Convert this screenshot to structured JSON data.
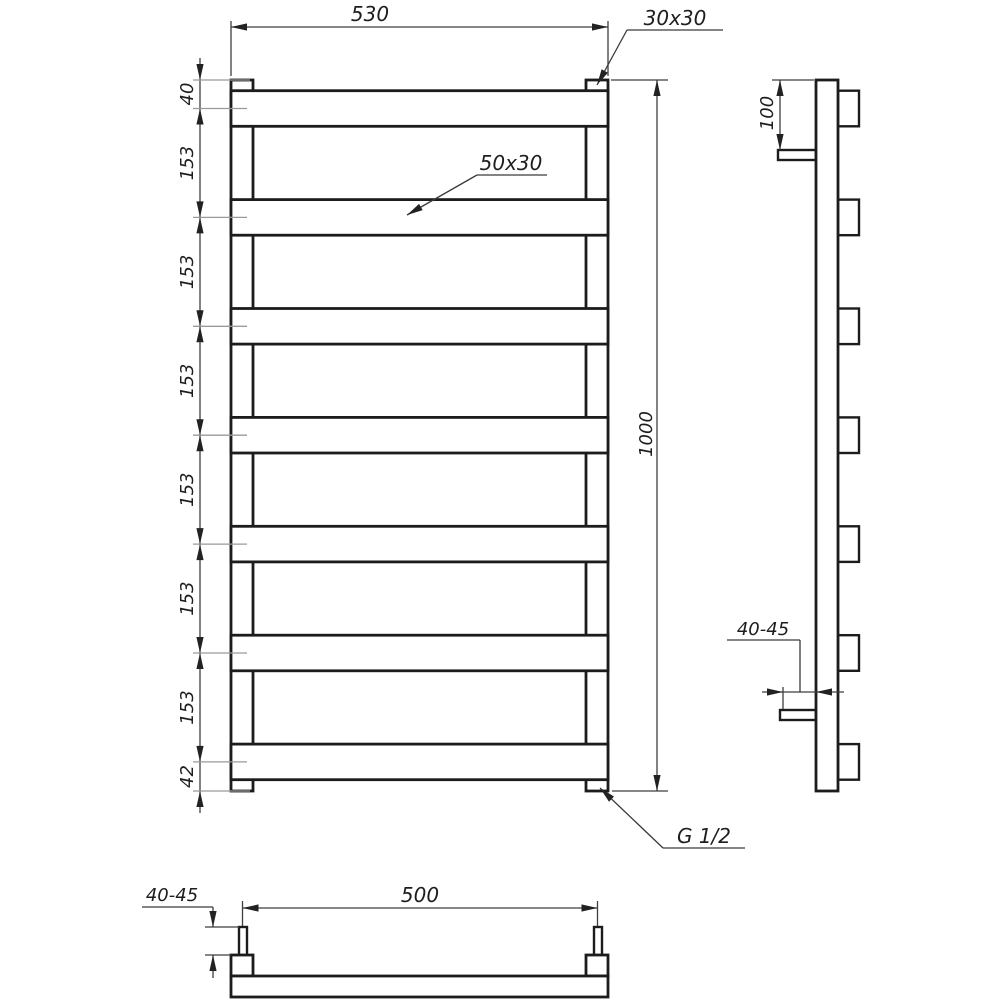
{
  "drawing": {
    "dimensions": {
      "overall_width": "530",
      "overall_height": "1000",
      "top_offset": "40",
      "bar_spacings": [
        "153",
        "153",
        "153",
        "153",
        "153",
        "153"
      ],
      "bottom_offset": "42",
      "bracket_top_offset": "100",
      "wall_distance_side": "40-45",
      "wall_distance_bottom": "40-45",
      "mounting_width": "500"
    },
    "labels": {
      "corner_tube_profile": "30x30",
      "bar_profile": "50x30",
      "thread": "G 1/2"
    },
    "colors": {
      "outline": "#1c1c1c",
      "dimension_line": "#3f3f3f",
      "tick_line": "#9a9a9a",
      "text": "#1e1e1e",
      "background": "#ffffff"
    }
  }
}
